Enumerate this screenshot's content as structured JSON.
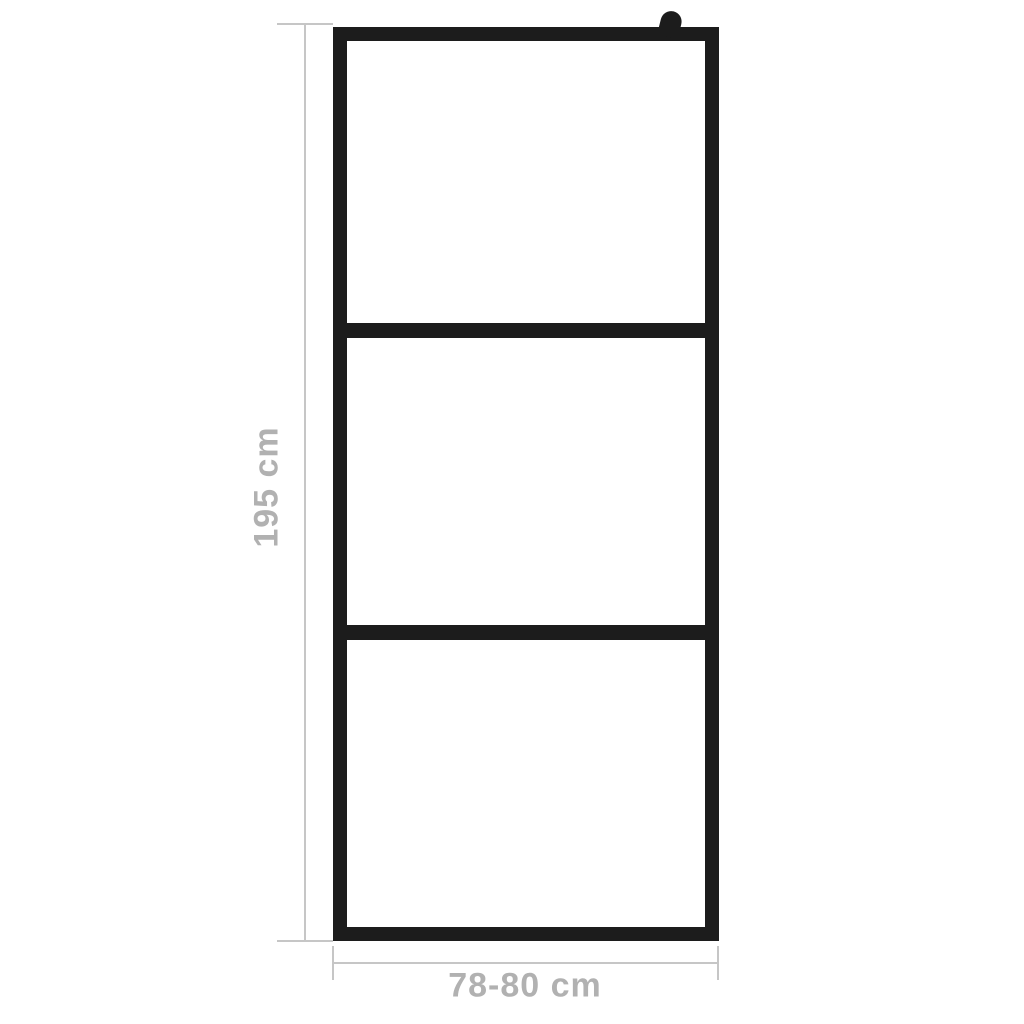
{
  "diagram": {
    "subject": "walk-in shower screen with black frame and three glass panels",
    "panel_count": 3,
    "colors": {
      "background": "#ffffff",
      "frame": "#1c1c1c",
      "dimension_line": "#c6c6c6",
      "dimension_text": "#b1b1b1"
    }
  },
  "dimensions": {
    "height": {
      "label": "195 cm"
    },
    "width": {
      "label": "78-80 cm"
    }
  }
}
